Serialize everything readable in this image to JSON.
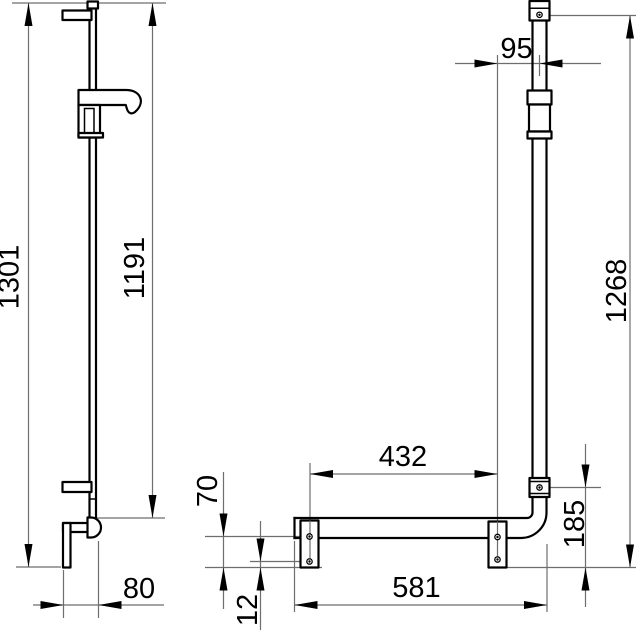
{
  "drawing": {
    "type": "technical-dimension-drawing",
    "description": "Shower rail with L-shaped grab bar, side view and front view with millimetre dimensions",
    "colors": {
      "background": "#ffffff",
      "object_line": "#000000",
      "dimension_line": "#6e6e6e",
      "text": "#000000"
    },
    "side_view": {
      "labels": {
        "overall_height": "1301",
        "rail_top_height": "1191",
        "wall_distance": "80"
      }
    },
    "front_view": {
      "labels": {
        "rod_offset": "95",
        "bar_height": "1268",
        "bracket_spacing": "432",
        "bracket_height": "70",
        "lower_mount_height": "185",
        "bar_width": "581",
        "plate_overhang": "12"
      }
    }
  }
}
